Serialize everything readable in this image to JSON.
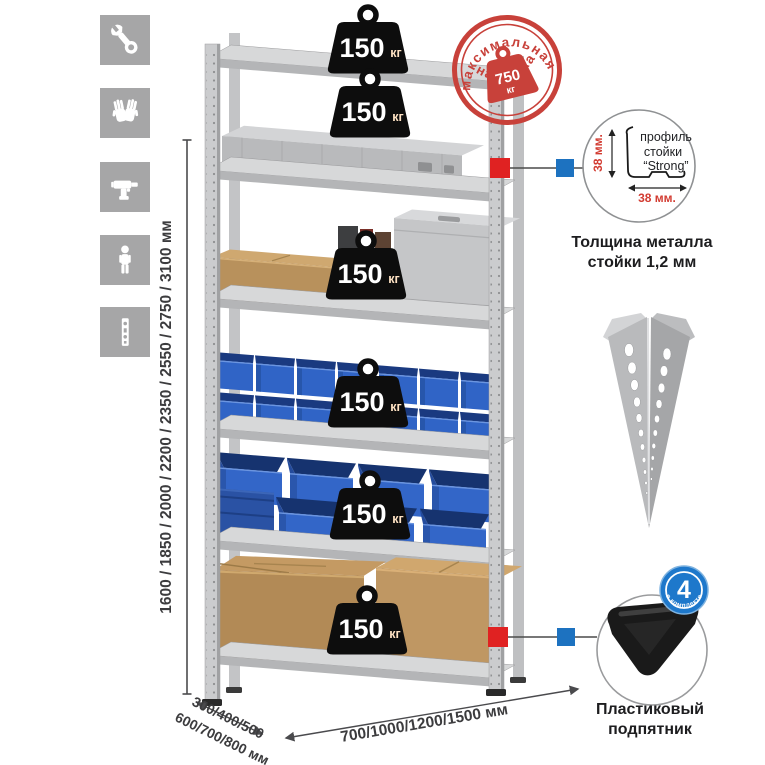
{
  "product": {
    "shelf_badges": [
      {
        "value": "150",
        "unit": "кг"
      },
      {
        "value": "150",
        "unit": "кг"
      },
      {
        "value": "150",
        "unit": "кг"
      },
      {
        "value": "150",
        "unit": "кг"
      },
      {
        "value": "150",
        "unit": "кг"
      },
      {
        "value": "150",
        "unit": "кг"
      }
    ],
    "stamp": {
      "arc_top": "максимальная",
      "arc_bottom": "нагрузка",
      "value": "750",
      "unit": "кг"
    },
    "dimensions": {
      "height": "1600 / 1850 / 2000 / 2200 / 2350 / 2550 / 2750 / 3100 мм",
      "depth_top": "300/400/500",
      "depth_bottom": "600/700/800 мм",
      "width": "700/1000/1200/1500 мм"
    },
    "profile_detail": {
      "label_line1": "профиль",
      "label_line2": "стойки",
      "label_line3": "“Strong”",
      "dim_vertical": "38 мм.",
      "dim_horizontal": "38 мм.",
      "caption_line1": "Толщина металла",
      "caption_line2": "стойки 1,2 мм"
    },
    "foot_detail": {
      "badge_value": "4",
      "badge_caption": "в комплекте",
      "caption_line1": "Пластиковый",
      "caption_line2": "подпятник"
    },
    "icons": [
      {
        "name": "wrench-icon"
      },
      {
        "name": "gloves-icon"
      },
      {
        "name": "drill-icon"
      },
      {
        "name": "person-icon"
      },
      {
        "name": "perforated-post-icon"
      }
    ],
    "colors": {
      "accent_red": "#c8413a",
      "marker_red": "#e02222",
      "marker_blue": "#1d72c0",
      "bin_blue": "#3064c6",
      "metal_gray": "#c9cacb",
      "badge_black": "#0d0d0d",
      "icon_gray": "#a6a6a7"
    }
  }
}
